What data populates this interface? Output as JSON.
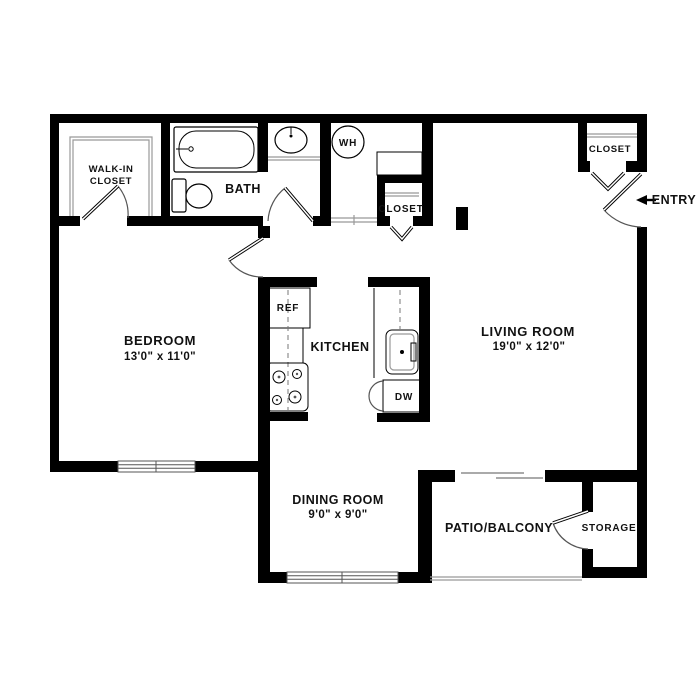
{
  "rooms": {
    "bedroom": {
      "name": "BEDROOM",
      "dims": "13'0\" x 11'0\""
    },
    "living_room": {
      "name": "LIVING ROOM",
      "dims": "19'0\" x 12'0\""
    },
    "dining_room": {
      "name": "DINING ROOM",
      "dims": "9'0\" x 9'0\""
    },
    "kitchen": {
      "name": "KITCHEN"
    },
    "bath": {
      "name": "BATH"
    },
    "walk_in_closet": {
      "line1": "WALK-IN",
      "line2": "CLOSET"
    },
    "patio": {
      "name": "PATIO/BALCONY"
    },
    "storage": {
      "name": "STORAGE"
    },
    "hall_closet": {
      "name": "CLOSET"
    },
    "entry_closet": {
      "name": "CLOSET"
    }
  },
  "fixtures": {
    "refrigerator": "REF",
    "dishwasher": "DW",
    "water_heater": "WH"
  },
  "entry": {
    "label": "ENTRY"
  },
  "colors": {
    "background": "#ffffff",
    "walls": "#000000",
    "light_lines": "#999999",
    "text": "#111111"
  }
}
